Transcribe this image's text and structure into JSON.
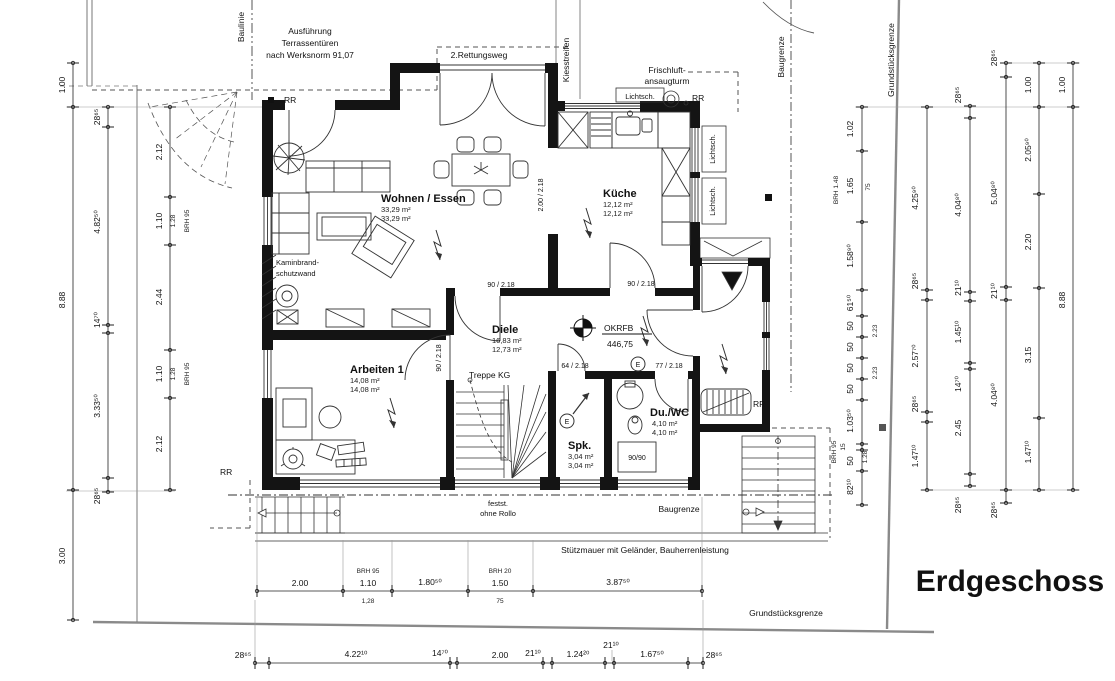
{
  "title": "Erdgeschoss",
  "notes": {
    "ausfuehrung_1": "Ausführung",
    "ausfuehrung_2": "Terrassentüren",
    "ausfuehrung_3": "nach Werksnorm 91,07",
    "rettungsweg": "2.Rettungsweg",
    "baulinie": "Baulinie",
    "kiesstreifen": "Kiesstreifen",
    "frischluft_1": "Frischluft-",
    "frischluft_2": "ansaugturm",
    "lichtsch": "Lichtsch.",
    "rr": "RR",
    "baugrenze": "Baugrenze",
    "grundstuecksgrenze": "Grundstücksgrenze",
    "kaminbrand_1": "Kaminbrand-",
    "kaminbrand_2": "schutzwand",
    "treppe_kg": "Treppe KG",
    "okrfb": "OKRFB",
    "okrfb_value": "446,75",
    "festst_1": "festst.",
    "festst_2": "ohne Rollo",
    "stuetzmauer": "Stützmauer mit Geländer, Bauherrenleistung",
    "e_symbol": "E"
  },
  "rooms": {
    "wohnen": {
      "name": "Wohnen / Essen",
      "area1": "33,29 m²",
      "area2": "33,29 m²"
    },
    "kueche": {
      "name": "Küche",
      "area1": "12,12 m²",
      "area2": "12,12 m²"
    },
    "diele": {
      "name": "Diele",
      "area1": "16,83 m²",
      "area2": "12,73 m²"
    },
    "arbeiten": {
      "name": "Arbeiten 1",
      "area1": "14,08 m²",
      "area2": "14,08 m²"
    },
    "duwc": {
      "name": "Du./WC",
      "area1": "4,10 m²",
      "area2": "4,10 m²"
    },
    "spk": {
      "name": "Spk.",
      "area1": "3,04 m²",
      "area2": "3,04 m²"
    }
  },
  "doors": {
    "d90": "90 / 2.18",
    "d200": "2.00 / 2.18",
    "d64": "64 / 2.18",
    "d77": "77 / 2.18",
    "shower": "90/90"
  },
  "dims": {
    "a": [
      "1.00",
      "8.88",
      "3.00"
    ],
    "b": [
      "28⁶⁵",
      "4.82⁵⁰",
      "14⁷⁰",
      "3.33⁵⁰",
      "28⁶⁵"
    ],
    "c": [
      "2.12",
      "1.10",
      "2.44",
      "1.10",
      "2.12"
    ],
    "c_sub": [
      "1.28",
      "BRH 95"
    ],
    "r1": [
      "1.02",
      "1.65",
      "1.58⁹⁰",
      "61⁵⁰",
      "50",
      "50",
      "50",
      "50",
      "1.03⁵⁰",
      "15",
      "50",
      "82¹⁰"
    ],
    "r1_sub": [
      "BRH 1.48",
      "75",
      "2.23",
      "2.23",
      "1.28",
      "BRH 95"
    ],
    "r2": [
      "4.25⁹⁰",
      "28⁶⁵",
      "2.57⁷⁰",
      "28⁶⁵",
      "1.47¹⁰"
    ],
    "r3": [
      "28⁶⁵",
      "4.04⁸⁰",
      "21¹⁰",
      "1.45¹⁰",
      "14⁷⁰",
      "2.45",
      "28⁶⁵"
    ],
    "r4": [
      "28⁶⁵",
      "5.04⁸⁰",
      "21¹⁰",
      "4.04⁸⁰",
      "28⁶⁵"
    ],
    "r5": [
      "1.00",
      "2.05⁹⁰",
      "2.20",
      "3.15",
      "1.47¹⁰"
    ],
    "r6": [
      "1.00",
      "8.88"
    ],
    "s1": [
      "2.00",
      "1.10",
      "1.80⁵⁰",
      "1.50",
      "3.87⁵⁰"
    ],
    "s1_sub": [
      "BRH 95",
      "1,28",
      "BRH 20",
      "75"
    ],
    "s2": [
      "28⁶⁵",
      "4.22¹⁰",
      "14⁷⁰",
      "2.00",
      "21¹⁰",
      "1.24²⁰",
      "21¹⁰",
      "1.67⁵⁰",
      "28⁶⁵"
    ]
  }
}
